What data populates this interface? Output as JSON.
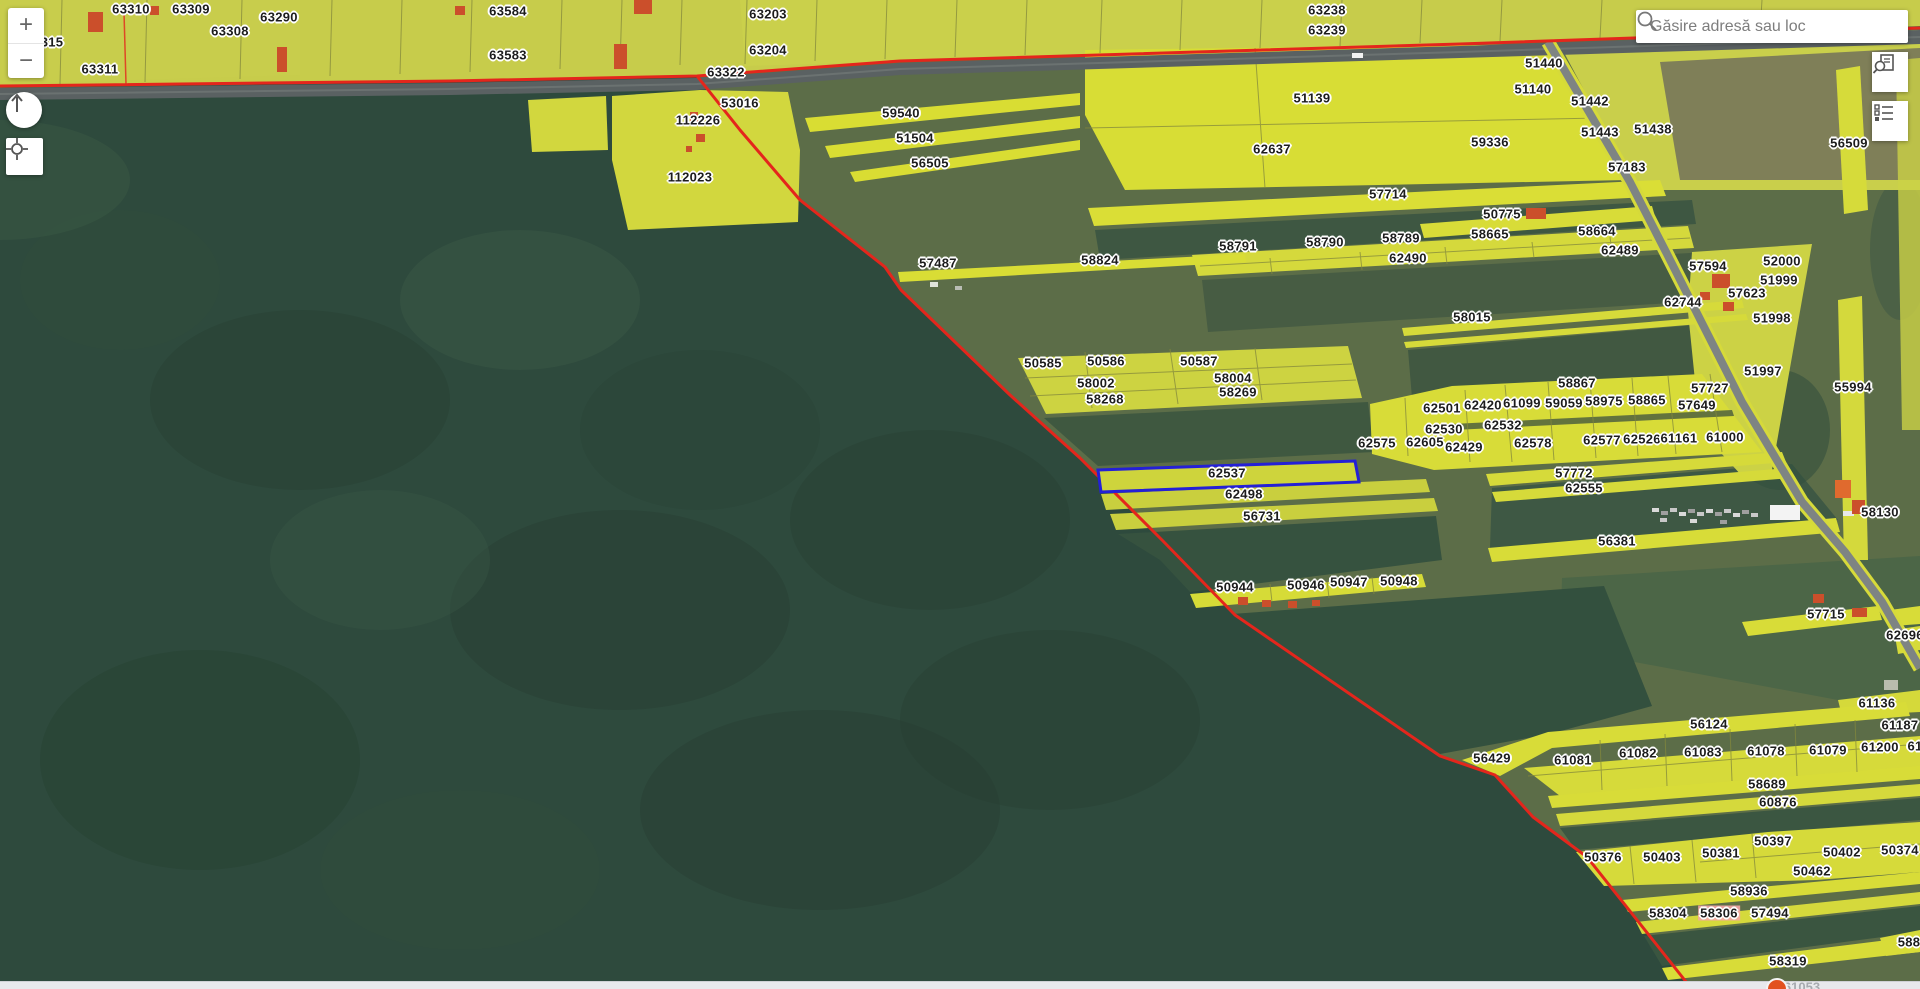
{
  "ui": {
    "search": {
      "placeholder": "Găsire adresă sau loc"
    },
    "controls": {
      "zoom_in": "+",
      "zoom_out": "−"
    },
    "icons": {
      "search": "magnifier-icon",
      "compass": "north-arrow-icon",
      "locate": "crosshair-icon",
      "button1": "document-search-icon",
      "button2": "legend-list-icon"
    }
  },
  "bottom_bar": {
    "partial_label": "61053"
  },
  "map": {
    "selected_parcel": "62537",
    "colors": {
      "parcel_yellow": "#d8dc38",
      "farmland_olive": "#5c6d48",
      "forest_green": "#2e4a3d",
      "boundary_red": "#e4261c",
      "selection_blue": "#2420d6",
      "building_orange": "#cb4f2b",
      "highlight_pink": "#f2a7a7",
      "road_gray": "#5a6162"
    },
    "parcel_labels": [
      {
        "t": "315",
        "x": 52,
        "y": 42
      },
      {
        "t": "63310",
        "x": 131,
        "y": 9
      },
      {
        "t": "63309",
        "x": 191,
        "y": 9
      },
      {
        "t": "63308",
        "x": 230,
        "y": 31
      },
      {
        "t": "63290",
        "x": 279,
        "y": 17
      },
      {
        "t": "63311",
        "x": 100,
        "y": 69
      },
      {
        "t": "63584",
        "x": 508,
        "y": 11
      },
      {
        "t": "63583",
        "x": 508,
        "y": 55
      },
      {
        "t": "63203",
        "x": 768,
        "y": 14
      },
      {
        "t": "63204",
        "x": 768,
        "y": 50
      },
      {
        "t": "63322",
        "x": 726,
        "y": 72
      },
      {
        "t": "63238",
        "x": 1327,
        "y": 10
      },
      {
        "t": "63239",
        "x": 1327,
        "y": 30
      },
      {
        "t": "53016",
        "x": 740,
        "y": 103
      },
      {
        "t": "112226",
        "x": 698,
        "y": 120
      },
      {
        "t": "112023",
        "x": 690,
        "y": 177
      },
      {
        "t": "59540",
        "x": 901,
        "y": 113
      },
      {
        "t": "51504",
        "x": 915,
        "y": 138
      },
      {
        "t": "56505",
        "x": 930,
        "y": 163
      },
      {
        "t": "51440",
        "x": 1544,
        "y": 63
      },
      {
        "t": "51139",
        "x": 1312,
        "y": 98
      },
      {
        "t": "51140",
        "x": 1533,
        "y": 89
      },
      {
        "t": "51442",
        "x": 1590,
        "y": 101
      },
      {
        "t": "51443",
        "x": 1600,
        "y": 132
      },
      {
        "t": "51438",
        "x": 1653,
        "y": 129
      },
      {
        "t": "59336",
        "x": 1490,
        "y": 142
      },
      {
        "t": "62637",
        "x": 1272,
        "y": 149
      },
      {
        "t": "57183",
        "x": 1627,
        "y": 167
      },
      {
        "t": "56509",
        "x": 1849,
        "y": 143
      },
      {
        "t": "57714",
        "x": 1388,
        "y": 194
      },
      {
        "t": "50775",
        "x": 1502,
        "y": 214
      },
      {
        "t": "58665",
        "x": 1490,
        "y": 234
      },
      {
        "t": "58664",
        "x": 1597,
        "y": 231
      },
      {
        "t": "58791",
        "x": 1238,
        "y": 246
      },
      {
        "t": "58790",
        "x": 1325,
        "y": 242
      },
      {
        "t": "58789",
        "x": 1401,
        "y": 238
      },
      {
        "t": "62490",
        "x": 1408,
        "y": 258
      },
      {
        "t": "62489",
        "x": 1620,
        "y": 250
      },
      {
        "t": "57487",
        "x": 938,
        "y": 263
      },
      {
        "t": "58824",
        "x": 1100,
        "y": 260
      },
      {
        "t": "57594",
        "x": 1708,
        "y": 266
      },
      {
        "t": "52000",
        "x": 1782,
        "y": 261
      },
      {
        "t": "51999",
        "x": 1779,
        "y": 280
      },
      {
        "t": "57623",
        "x": 1747,
        "y": 293
      },
      {
        "t": "62744",
        "x": 1683,
        "y": 302
      },
      {
        "t": "51998",
        "x": 1772,
        "y": 318
      },
      {
        "t": "58015",
        "x": 1472,
        "y": 317
      },
      {
        "t": "51997",
        "x": 1763,
        "y": 371
      },
      {
        "t": "55994",
        "x": 1853,
        "y": 387
      },
      {
        "t": "58867",
        "x": 1577,
        "y": 383
      },
      {
        "t": "57727",
        "x": 1710,
        "y": 388
      },
      {
        "t": "57649",
        "x": 1697,
        "y": 405
      },
      {
        "t": "50585",
        "x": 1043,
        "y": 363
      },
      {
        "t": "50586",
        "x": 1106,
        "y": 361
      },
      {
        "t": "50587",
        "x": 1199,
        "y": 361
      },
      {
        "t": "58002",
        "x": 1096,
        "y": 383
      },
      {
        "t": "58004",
        "x": 1233,
        "y": 378
      },
      {
        "t": "58268",
        "x": 1105,
        "y": 399
      },
      {
        "t": "58269",
        "x": 1238,
        "y": 392
      },
      {
        "t": "62501",
        "x": 1442,
        "y": 408
      },
      {
        "t": "62420",
        "x": 1483,
        "y": 405
      },
      {
        "t": "61099",
        "x": 1522,
        "y": 403
      },
      {
        "t": "59059",
        "x": 1564,
        "y": 403
      },
      {
        "t": "58975",
        "x": 1604,
        "y": 401
      },
      {
        "t": "58865",
        "x": 1647,
        "y": 400
      },
      {
        "t": "62530",
        "x": 1444,
        "y": 429
      },
      {
        "t": "62532",
        "x": 1503,
        "y": 425
      },
      {
        "t": "62575",
        "x": 1377,
        "y": 443
      },
      {
        "t": "62605",
        "x": 1425,
        "y": 442
      },
      {
        "t": "62429",
        "x": 1464,
        "y": 447
      },
      {
        "t": "62578",
        "x": 1533,
        "y": 443
      },
      {
        "t": "62577",
        "x": 1602,
        "y": 440
      },
      {
        "t": "62526",
        "x": 1642,
        "y": 439
      },
      {
        "t": "61161",
        "x": 1679,
        "y": 438
      },
      {
        "t": "61000",
        "x": 1725,
        "y": 437
      },
      {
        "t": "57772",
        "x": 1574,
        "y": 473
      },
      {
        "t": "62555",
        "x": 1584,
        "y": 488
      },
      {
        "t": "62537",
        "x": 1227,
        "y": 473
      },
      {
        "t": "62498",
        "x": 1244,
        "y": 494
      },
      {
        "t": "56731",
        "x": 1262,
        "y": 516
      },
      {
        "t": "58130",
        "x": 1880,
        "y": 512
      },
      {
        "t": "56381",
        "x": 1617,
        "y": 541
      },
      {
        "t": "50944",
        "x": 1235,
        "y": 587
      },
      {
        "t": "50946",
        "x": 1306,
        "y": 585
      },
      {
        "t": "50947",
        "x": 1349,
        "y": 582
      },
      {
        "t": "50948",
        "x": 1399,
        "y": 581
      },
      {
        "t": "57715",
        "x": 1826,
        "y": 614
      },
      {
        "t": "62696",
        "x": 1905,
        "y": 635
      },
      {
        "t": "61136",
        "x": 1877,
        "y": 703
      },
      {
        "t": "61187",
        "x": 1900,
        "y": 725
      },
      {
        "t": "56124",
        "x": 1709,
        "y": 724
      },
      {
        "t": "56429",
        "x": 1492,
        "y": 758
      },
      {
        "t": "61081",
        "x": 1573,
        "y": 760
      },
      {
        "t": "61082",
        "x": 1638,
        "y": 753
      },
      {
        "t": "61083",
        "x": 1703,
        "y": 752
      },
      {
        "t": "61078",
        "x": 1766,
        "y": 751
      },
      {
        "t": "61079",
        "x": 1828,
        "y": 750
      },
      {
        "t": "61200",
        "x": 1880,
        "y": 747
      },
      {
        "t": "61",
        "x": 1915,
        "y": 746
      },
      {
        "t": "58689",
        "x": 1767,
        "y": 784
      },
      {
        "t": "60876",
        "x": 1778,
        "y": 802
      },
      {
        "t": "50397",
        "x": 1773,
        "y": 841
      },
      {
        "t": "50376",
        "x": 1603,
        "y": 857
      },
      {
        "t": "50403",
        "x": 1662,
        "y": 857
      },
      {
        "t": "50381",
        "x": 1721,
        "y": 853
      },
      {
        "t": "50402",
        "x": 1842,
        "y": 852
      },
      {
        "t": "50374",
        "x": 1900,
        "y": 850
      },
      {
        "t": "50462",
        "x": 1812,
        "y": 871
      },
      {
        "t": "58936",
        "x": 1749,
        "y": 891
      },
      {
        "t": "58304",
        "x": 1668,
        "y": 913
      },
      {
        "t": "58306",
        "x": 1719,
        "y": 913,
        "s": "pink"
      },
      {
        "t": "57494",
        "x": 1770,
        "y": 913
      },
      {
        "t": "588",
        "x": 1909,
        "y": 942
      },
      {
        "t": "58319",
        "x": 1788,
        "y": 961
      }
    ]
  }
}
